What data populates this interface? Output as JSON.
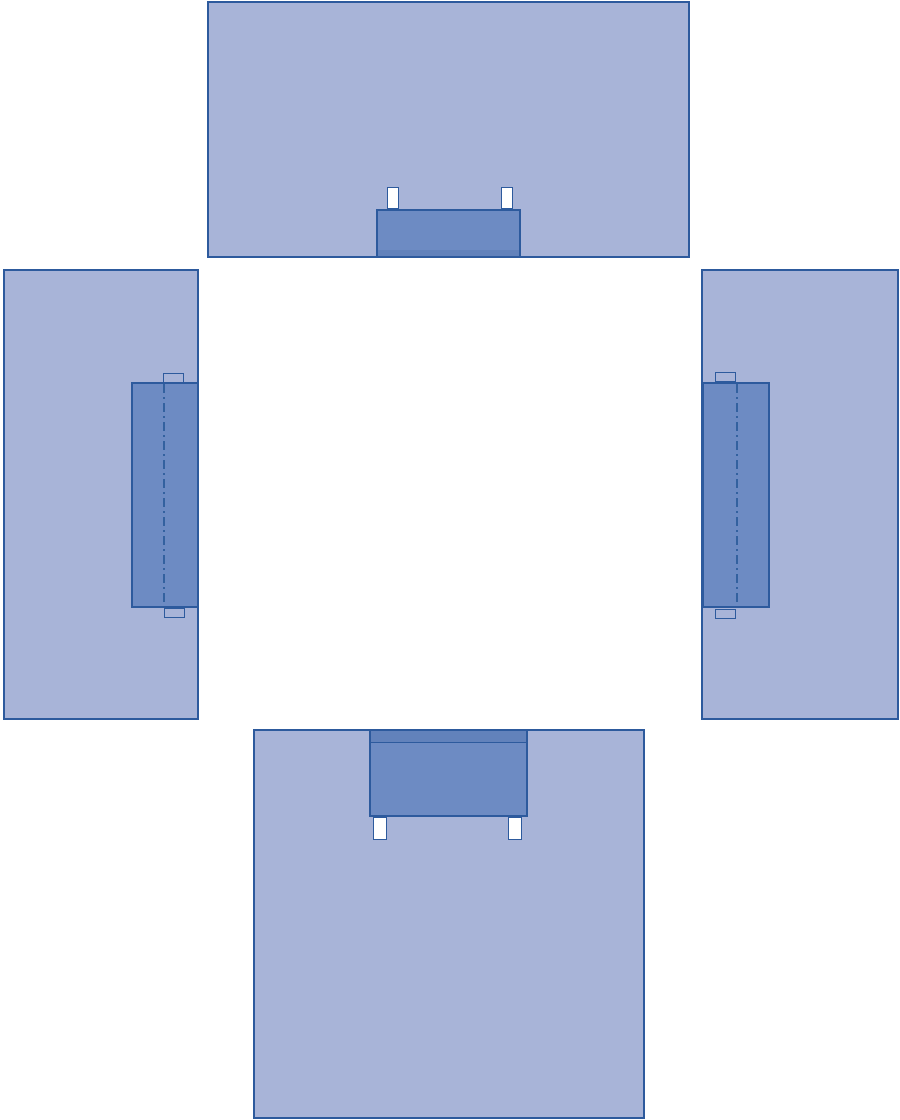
{
  "meta": {
    "description": "Schematic line diagram: four light-blue rectangular panels arranged around an empty white center (top, left, right, bottom). Each panel carries a darker blue reinforcement block on its inner edge. The left and right vertical blocks have a vertical dash-dot fold line and small light tabs at their ends; the top and bottom horizontal blocks have pairs of small white tabs; the bottom block has a darker strip along its top edge and the top block a darker strip along its bottom edge.",
    "text_content": "none (no visible text in image)"
  },
  "colors": {
    "background": "#ffffff",
    "panel-fill": "#a8b4d8",
    "panel-border": "#2d5a9d",
    "block-fill": "#6d8bc3",
    "block-strip-fill": "#6282bb",
    "tab-fill": "#ffffff",
    "fold-line": "#33619f"
  },
  "panels": {
    "top": {
      "position": "top center",
      "block": "horizontal darker block at bottom center, strip along its bottom, two small white tabs above it"
    },
    "left": {
      "position": "middle left",
      "block": "vertical darker block at inner (right) edge with dash-dot fold line and light tabs at top and bottom"
    },
    "right": {
      "position": "middle right",
      "block": "vertical darker block at inner (left) edge with dash-dot fold line and light tabs at top and bottom"
    },
    "bottom": {
      "position": "bottom center",
      "block": "horizontal darker block at top center, darker strip along its top, two small white tabs below it"
    }
  }
}
